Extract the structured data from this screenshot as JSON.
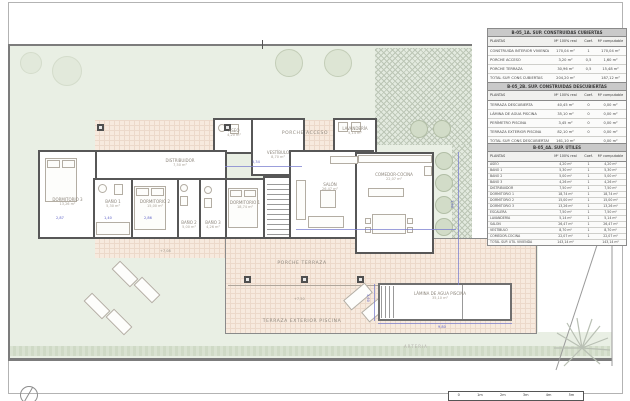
{
  "plan": {
    "porche_acceso": "PORCHE ACCESO",
    "porche_terraza": "PORCHE TERRAZA",
    "terraza_exterior": "TERRAZA EXTERIOR PISCINA",
    "pool_name": "LÁMINA DE AGUA PISCINA",
    "pool_area": "35,10 m²",
    "street": "ARTERIA",
    "level_terrace": "+7,50",
    "level_path": "+7,08",
    "rooms": {
      "dormitorio3": {
        "name": "DORMITORIO 3",
        "area": "13,26 m²"
      },
      "bano1": {
        "name": "BAÑO 1",
        "area": "5,30 m²"
      },
      "dormitorio2": {
        "name": "DORMITORIO 2",
        "area": "15,00 m²"
      },
      "bano2": {
        "name": "BAÑO 2",
        "area": "5,00 m²"
      },
      "bano3": {
        "name": "BAÑO 3",
        "area": "4,26 m²"
      },
      "dormitorio1": {
        "name": "DORMITORIO 1",
        "area": "18,74 m²"
      },
      "distribuidor": {
        "name": "DISTRIBUIDOR",
        "area": "7,50 m²"
      },
      "aseo": {
        "name": "ASEO",
        "area": "4,20 m²"
      },
      "vestibulo": {
        "name": "VESTÍBULO",
        "area": "8,70 m²"
      },
      "lavanderia": {
        "name": "LAVANDERÍA",
        "area": "5,14 m²"
      },
      "salon": {
        "name": "SALÓN",
        "area": "26,47 m²"
      },
      "comedor": {
        "name": "COMEDOR-COCINA",
        "area": "22,07 m²"
      }
    },
    "dims": {
      "d1": "5,34",
      "d2": "2,87",
      "d3": "1,40",
      "d4": "2,86",
      "d5": "9,80",
      "d6": "3,60",
      "d7": "1,80"
    }
  },
  "tables": [
    {
      "title": "B-05_1A. SUP. CONSTRUIDAS CUBIERTAS",
      "headers": {
        "c1": "PLANTAS",
        "c2": "M² 100% real",
        "c3": "Coef.",
        "c4": "M² computable"
      },
      "rows": [
        {
          "label": "CONSTRUIDA INTERIOR VIVIENDA",
          "real": "170,04 m²",
          "coef": "1",
          "comp": "170,04 m²"
        },
        {
          "label": "PORCHE ACCESO",
          "real": "3,20 m²",
          "coef": "0,5",
          "comp": "1,60 m²"
        },
        {
          "label": "PORCHE TERRAZA",
          "real": "30,96 m²",
          "coef": "0,5",
          "comp": "15,48 m²"
        },
        {
          "label": "TOTAL SUP. CONS CUBIERTAS",
          "real": "204,20 m²",
          "coef": "",
          "comp": "187,12 m²"
        }
      ]
    },
    {
      "title": "B-05_2B. SUP. CONSTRUIDAS DESCUBIERTAS",
      "headers": {
        "c1": "PLANTAS",
        "c2": "M² 100% real",
        "c3": "Coef.",
        "c4": "M² computable"
      },
      "rows": [
        {
          "label": "TERRAZA DESCUBIERTA",
          "real": "40,45 m²",
          "coef": "0",
          "comp": "0,00 m²"
        },
        {
          "label": "LÁMINA DE AGUA PISCINA",
          "real": "35,10 m²",
          "coef": "0",
          "comp": "0,00 m²"
        },
        {
          "label": "PERÍMETRO PISCINA",
          "real": "3,45 m²",
          "coef": "0",
          "comp": "0,00 m²"
        },
        {
          "label": "TERRAZA EXTERIOR PISCINA",
          "real": "82,10 m²",
          "coef": "0",
          "comp": "0,00 m²"
        },
        {
          "label": "TOTAL SUP. CONS DESCUBIERTAS",
          "real": "161,10 m²",
          "coef": "",
          "comp": "0,00 m²"
        }
      ]
    },
    {
      "title": "B-05_4A. SUP. ÚTILES",
      "headers": {
        "c1": "PLANTAS",
        "c2": "M² 100% real",
        "c3": "Coef.",
        "c4": "M² computable"
      },
      "rows": [
        {
          "label": "ASEO",
          "real": "4,20 m²",
          "coef": "1",
          "comp": "4,20 m²"
        },
        {
          "label": "BAÑO 1",
          "real": "5,30 m²",
          "coef": "1",
          "comp": "5,30 m²"
        },
        {
          "label": "BAÑO 2",
          "real": "5,00 m²",
          "coef": "1",
          "comp": "5,00 m²"
        },
        {
          "label": "BAÑO 3",
          "real": "4,26 m²",
          "coef": "1",
          "comp": "4,26 m²"
        },
        {
          "label": "DISTRIBUIDOR",
          "real": "7,50 m²",
          "coef": "1",
          "comp": "7,50 m²"
        },
        {
          "label": "DORMITORIO 1",
          "real": "18,74 m²",
          "coef": "1",
          "comp": "18,74 m²"
        },
        {
          "label": "DORMITORIO 2",
          "real": "15,00 m²",
          "coef": "1",
          "comp": "15,00 m²"
        },
        {
          "label": "DORMITORIO 3",
          "real": "13,26 m²",
          "coef": "1",
          "comp": "13,26 m²"
        },
        {
          "label": "ESCALERA",
          "real": "7,50 m²",
          "coef": "1",
          "comp": "7,50 m²"
        },
        {
          "label": "LAVANDERÍA",
          "real": "5,14 m²",
          "coef": "1",
          "comp": "5,14 m²"
        },
        {
          "label": "SALÓN",
          "real": "26,47 m²",
          "coef": "1",
          "comp": "26,47 m²"
        },
        {
          "label": "VESTÍBULO",
          "real": "8,70 m²",
          "coef": "1",
          "comp": "8,70 m²"
        },
        {
          "label": "COMEDOR-COCINA",
          "real": "22,07 m²",
          "coef": "1",
          "comp": "22,07 m²"
        },
        {
          "label": "TOTAL SUP. ÚTIL VIVIENDA",
          "real": "143,14 m²",
          "coef": "",
          "comp": "143,14 m²"
        }
      ]
    }
  ],
  "scalebar": {
    "ticks": [
      "0",
      "1m",
      "2m",
      "3m",
      "4m",
      "5m"
    ]
  },
  "colors": {
    "wall": "#575757",
    "garden": "#e9efe4",
    "tile": "#f7eade",
    "hatch": "#e3eadf",
    "dimension_blue": "#6a6ecb",
    "table_header_bg": "#c9c9c9"
  }
}
